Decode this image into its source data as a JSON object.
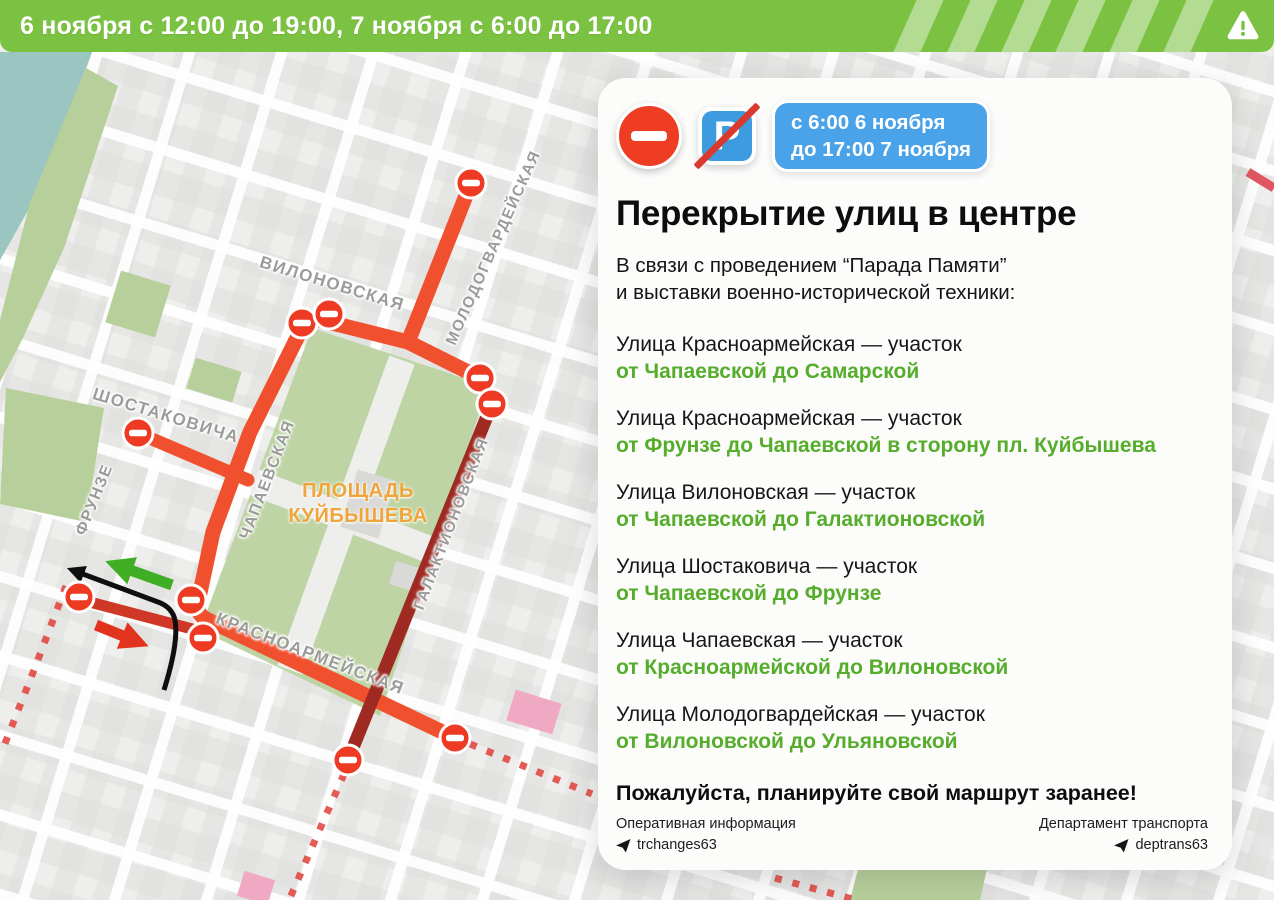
{
  "header": {
    "text": "6 ноября с 12:00 до 19:00, 7 ноября с 6:00 до 17:00",
    "warning_icon": "warning-triangle"
  },
  "map": {
    "street_labels": [
      {
        "id": "vilonovskaya",
        "text": "ВИЛОНОВСКАЯ"
      },
      {
        "id": "molodogvardeyskaya",
        "text": "МОЛОДОГВАРДЕЙСКАЯ"
      },
      {
        "id": "shostakovicha",
        "text": "ШОСТАКОВИЧА"
      },
      {
        "id": "frunze",
        "text": "ФРУНЗЕ"
      },
      {
        "id": "chapaevskaya",
        "text": "ЧАПАЕВСКАЯ"
      },
      {
        "id": "krasnoarmeyskaya",
        "text": "КРАСНОАРМЕЙСКАЯ"
      },
      {
        "id": "galaktionovskaya",
        "text": "ГАЛАКТИОНОВСКАЯ"
      }
    ],
    "square_label": {
      "line1": "ПЛОЩАДЬ",
      "line2": "КУЙБЫШЕВА"
    }
  },
  "card": {
    "signs": [
      "no-entry",
      "no-parking"
    ],
    "badge": {
      "line1": "с 6:00 6 ноября",
      "line2": "до 17:00 7 ноября"
    },
    "title": "Перекрытие улиц в центре",
    "intro_line1": "В связи с проведением “Парада Памяти”",
    "intro_line2": "и выставки военно-исторической техники:",
    "closures": [
      {
        "street": "Улица Красноармейская — участок",
        "section": "от Чапаевской до Самарской"
      },
      {
        "street": "Улица Красноармейская — участок",
        "section": "от Фрунзе до Чапаевской в сторону пл. Куйбышева"
      },
      {
        "street": "Улица Вилоновская — участок",
        "section": "от Чапаевской до Галактионовской"
      },
      {
        "street": "Улица Шостаковича — участок",
        "section": "от Чапаевской до Фрунзе"
      },
      {
        "street": "Улица Чапаевская — участок",
        "section": "от Красноармейской до Вилоновской"
      },
      {
        "street": "Улица Молодогвардейская — участок",
        "section": "от Вилоновской до Ульяновской"
      }
    ],
    "closing": "Пожалуйста, планируйте свой маршрут заранее!",
    "footer_left": {
      "label": "Оперативная информация",
      "handle": "trchanges63"
    },
    "footer_right": {
      "label": "Департамент транспорта",
      "handle": "deptrans63"
    }
  },
  "colors": {
    "header_green": "#7cc242",
    "closure_orange": "#f1502e",
    "closure_dark_red": "#9e2a22",
    "closure_crimson": "#cf3726",
    "dashed_red": "#e04038",
    "badge_blue": "#4aa2e9",
    "green_text": "#55ad2b",
    "square_label_orange": "#f0a43c",
    "park_green": "#bed4a4",
    "water_teal": "#9ac5c0",
    "pink_building": "#f0a9c2"
  }
}
